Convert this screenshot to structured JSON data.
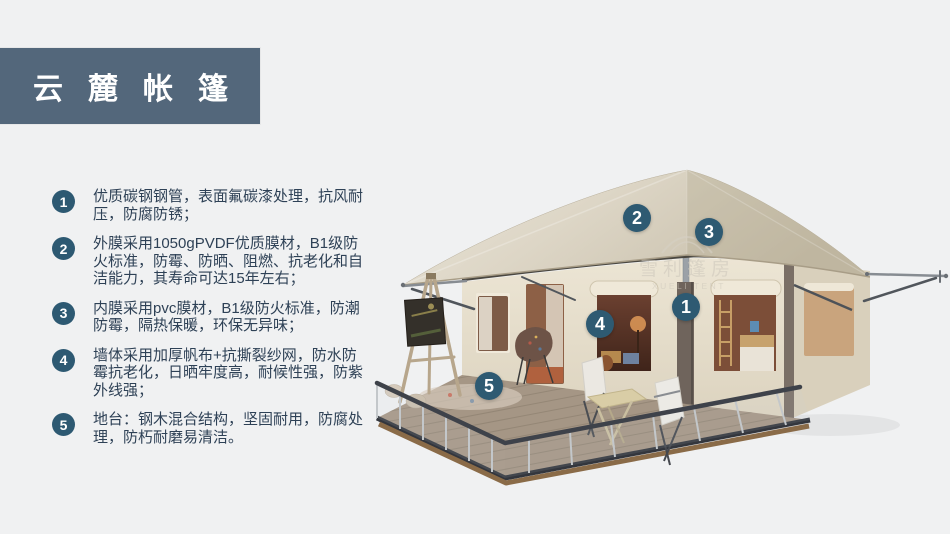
{
  "title": {
    "text": "云麓帐篷"
  },
  "features": [
    {
      "num": "1",
      "text": "优质碳钢钢管，表面氟碳漆处理，抗风耐压，防腐防锈；"
    },
    {
      "num": "2",
      "text": "外膜采用1050gPVDF优质膜材，B1级防火标准，防霉、防晒、阻燃、抗老化和自洁能力，其寿命可达15年左右；"
    },
    {
      "num": "3",
      "text": "内膜采用pvc膜材，B1级防火标准，防潮防霉，隔热保暖，环保无异味；"
    },
    {
      "num": "4",
      "text": "墙体采用加厚帆布+抗撕裂纱网，防水防霉抗老化，日晒牢度高，耐候性强，防紫外线强；"
    },
    {
      "num": "5",
      "text": "地台：钢木混合结构，坚固耐用，防腐处理，防朽耐磨易清洁。"
    }
  ],
  "callouts": [
    {
      "num": "1"
    },
    {
      "num": "2"
    },
    {
      "num": "3"
    },
    {
      "num": "4"
    },
    {
      "num": "5"
    }
  ],
  "watermark": {
    "cn": "雪利篷房",
    "en": "XUELI TENT"
  },
  "colors": {
    "accent_badge": "#2e5a72",
    "title_bar": "#53677b",
    "body_text": "#2e4156",
    "canvas": "#f0f1f2",
    "roof_beige": "#d9d2c2",
    "wall_cream": "#e6dfce",
    "deck_wood": "#a59685"
  }
}
